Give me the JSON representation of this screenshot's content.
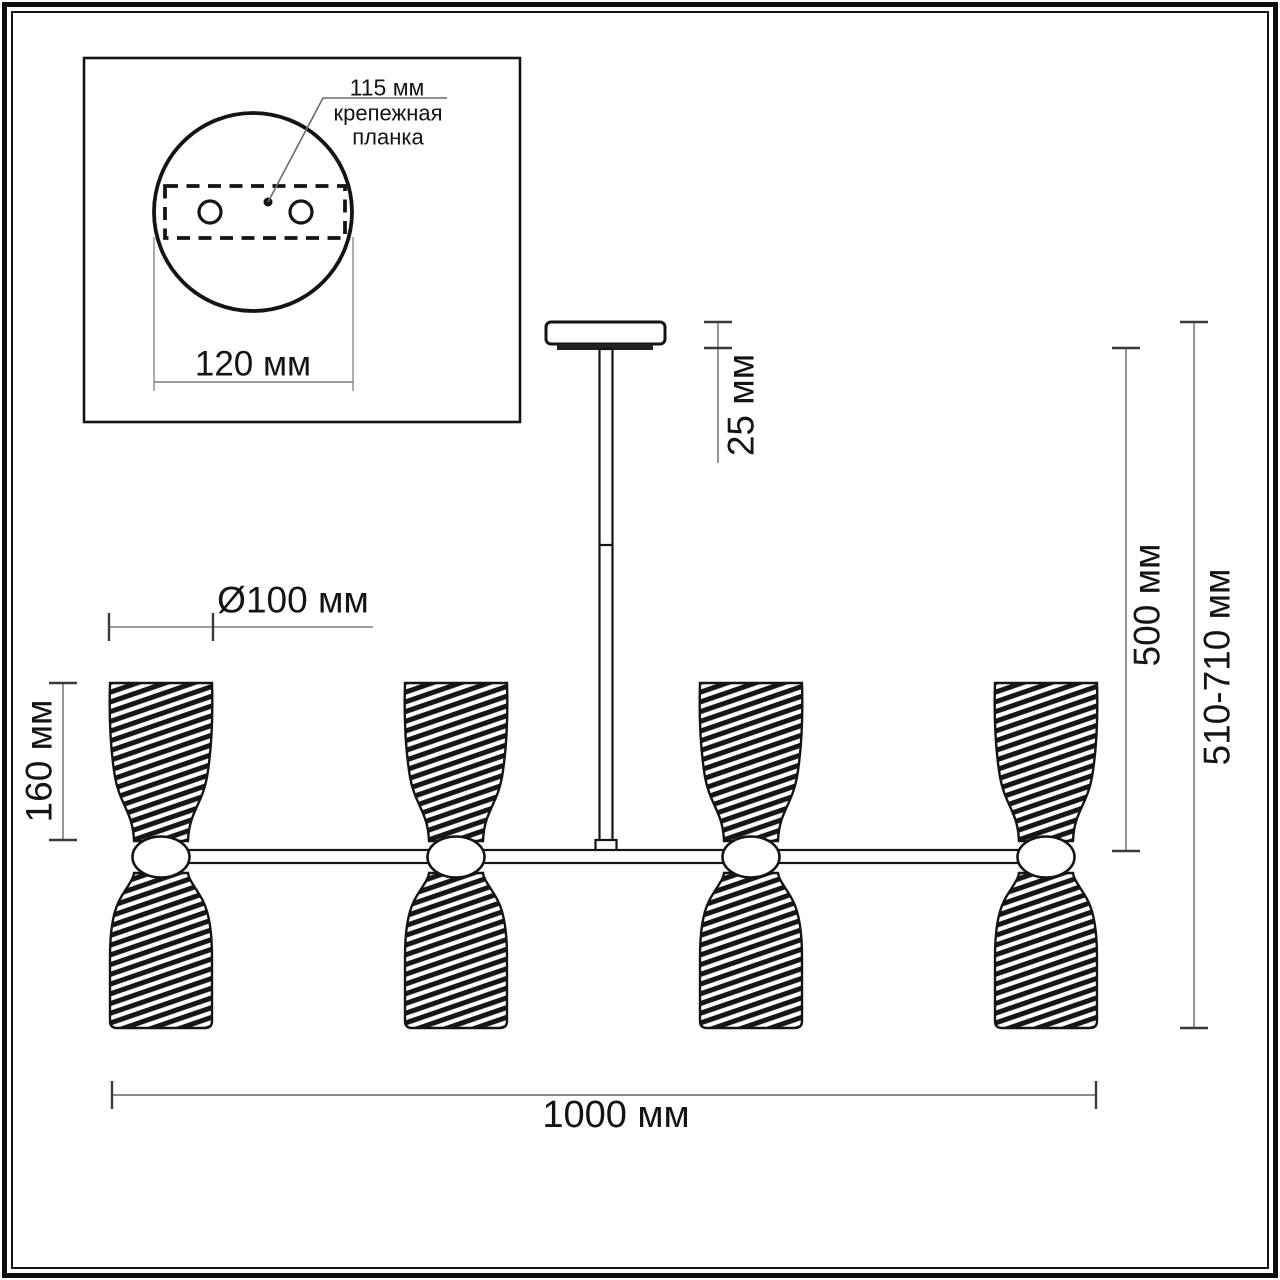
{
  "title": "Ceiling chandelier technical dimension drawing",
  "inset": {
    "hole_spacing_label": "115 мм",
    "plate_label": "крепежная планка",
    "canopy_diameter_label": "120 мм"
  },
  "dimensions": {
    "canopy_height": "25 мм",
    "rod_length": "500 мм",
    "total_height": "510-710 мм",
    "shade_height": "160 мм",
    "shade_diameter": "Ø100 мм",
    "total_width": "1000 мм"
  },
  "colors": {
    "line": "#141414",
    "dim_line": "#7b7b7b",
    "tick": "#3a3a3a",
    "leader": "#6a6a6a",
    "background": "#ffffff"
  }
}
